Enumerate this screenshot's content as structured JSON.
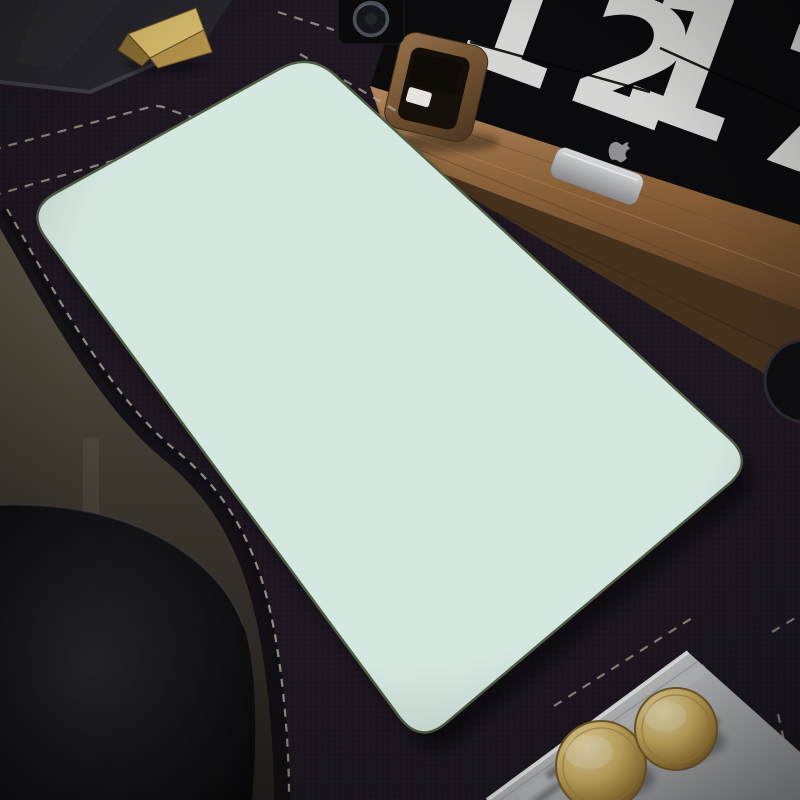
{
  "clock": {
    "hours": "12",
    "minutes": "17"
  },
  "colors": {
    "mat": "#1e1722",
    "matFleck": "#2e2433",
    "stitch": "#b3ada2",
    "floorTop": "#554e3f",
    "floorBottom": "#27231f",
    "chairLight": "#232327",
    "chairDark": "#0a0a0c",
    "woodLight": "#aa7e51",
    "woodMid": "#8a6038",
    "woodDark": "#5e4126",
    "woodFront": "#46311d",
    "screen": "#0b0b0d",
    "digit": "#d5d5d3",
    "appleGray": "#909092",
    "standLight": "#d3d5d7",
    "standDark": "#8e9093",
    "clockWoodL": "#8e6b45",
    "clockWoodD": "#523a23",
    "clockFace": "#150f09",
    "clockCard": "#e7e4dd",
    "speaker": "#0a0a0c",
    "speakerRing": "#4a4e57",
    "lid": "#26262c",
    "lidEdge": "#47474f",
    "goldL": "#dabe6c",
    "goldM": "#b5934a",
    "goldD": "#8a6f33",
    "disc": "#0e0e10",
    "discRing": "#2c2c31",
    "boxL": "#dcdddf",
    "boxM": "#b9babd",
    "boxD": "#929498",
    "knobL": "#f0e0ab",
    "knobM": "#d4b166",
    "knobD": "#8e7236",
    "padBase": "#a9c98c",
    "leafLight": "#c3dba4",
    "leafPale": "#ddeac8",
    "leafMid": "#93bd74",
    "leafDeep": "#7dab62",
    "padOutline": "#3c4c32",
    "mint": "#d5e8df",
    "wind": "#64756b",
    "cream": "#f0ead6",
    "white": "#f8f5ec",
    "yellow": "#eed699",
    "tan": "#e2bf7e",
    "bunny": "#fcfaf2"
  },
  "pad": {
    "corners": {
      "left": [
        25,
        210
      ],
      "top": [
        310,
        52
      ],
      "right": [
        755,
        462
      ],
      "bottom": [
        420,
        745
      ]
    },
    "corner_radius": 35,
    "illustration": {
      "border_leaf_counts": [
        46,
        78,
        60,
        84
      ],
      "seed": 11,
      "clumps": [
        [
          598,
          528,
          14,
          55
        ],
        [
          430,
          168,
          8,
          34
        ],
        [
          150,
          340,
          10,
          40
        ],
        [
          255,
          555,
          10,
          45
        ]
      ],
      "flowers": [
        {
          "t": "tulip",
          "x": 232,
          "y": 213,
          "s": 1.0,
          "r": -120
        },
        {
          "t": "cloud_white",
          "x": 292,
          "y": 197,
          "s": 0.85,
          "r": 10
        },
        {
          "t": "cloud_white",
          "x": 326,
          "y": 256,
          "s": 0.7,
          "r": -15
        },
        {
          "t": "cloud_yellow",
          "x": 253,
          "y": 241,
          "s": 1.0,
          "r": 0
        },
        {
          "t": "cloud_white",
          "x": 296,
          "y": 382,
          "s": 1.05,
          "r": 20
        },
        {
          "t": "cloud_white",
          "x": 668,
          "y": 413,
          "s": 0.8,
          "r": 0
        },
        {
          "t": "cloud_yellow",
          "x": 462,
          "y": 524,
          "s": 0.85,
          "r": 25
        },
        {
          "t": "cloud_yellow",
          "x": 333,
          "y": 500,
          "s": 1.35,
          "r": -10
        },
        {
          "t": "tulip",
          "x": 295,
          "y": 486,
          "s": 0.9,
          "r": -30
        },
        {
          "t": "cloud_yellow",
          "x": 352,
          "y": 612,
          "s": 1.1,
          "r": 15
        },
        {
          "t": "cloud_cream",
          "x": 694,
          "y": 437,
          "s": 0.75,
          "r": 40
        },
        {
          "t": "cloud_cream",
          "x": 718,
          "y": 503,
          "s": 0.8,
          "r": 0
        },
        {
          "t": "cloud_cream",
          "x": 311,
          "y": 133,
          "s": 0.95,
          "r": 0
        },
        {
          "t": "cloud_cream",
          "x": 342,
          "y": 140,
          "s": 0.8,
          "r": 30
        },
        {
          "t": "cloud_yellow",
          "x": 241,
          "y": 123,
          "s": 0.6,
          "r": 0
        },
        {
          "t": "tulip",
          "x": 88,
          "y": 172,
          "s": 0.9,
          "r": -35
        },
        {
          "t": "tulip",
          "x": 62,
          "y": 250,
          "s": 0.95,
          "r": -15
        },
        {
          "t": "tulip",
          "x": 85,
          "y": 273,
          "s": 0.8,
          "r": 20
        },
        {
          "t": "tulip",
          "x": 58,
          "y": 302,
          "s": 0.85,
          "r": -40
        },
        {
          "t": "tulip",
          "x": 92,
          "y": 322,
          "s": 0.75,
          "r": 10
        },
        {
          "t": "tulip",
          "x": 232,
          "y": 446,
          "s": 0.85,
          "r": -25
        },
        {
          "t": "cloud_yellow",
          "x": 562,
          "y": 658,
          "s": 0.9,
          "r": 0
        },
        {
          "t": "cloud_cream",
          "x": 270,
          "y": 162,
          "s": 0.7,
          "r": 0
        },
        {
          "t": "cloud_white",
          "x": 180,
          "y": 95,
          "s": 0.6,
          "r": 0
        },
        {
          "t": "tulip",
          "x": 430,
          "y": 178,
          "s": 0.7,
          "r": 160
        },
        {
          "t": "cloud_cream",
          "x": 152,
          "y": 128,
          "s": 0.7,
          "r": 0
        },
        {
          "t": "cloud_yellow",
          "x": 208,
          "y": 105,
          "s": 0.55,
          "r": 0
        }
      ],
      "leaves": [
        [
          196,
          195,
          40,
          0.9
        ],
        [
          316,
          232,
          10,
          0.7
        ],
        [
          422,
          157,
          -15,
          0.85
        ],
        [
          452,
          166,
          20,
          0.8
        ],
        [
          570,
          429,
          5,
          0.9
        ],
        [
          412,
          537,
          -20,
          0.95
        ],
        [
          513,
          548,
          10,
          0.7
        ],
        [
          618,
          468,
          25,
          0.7
        ],
        [
          247,
          318,
          -30,
          0.6
        ],
        [
          365,
          300,
          15,
          0.6
        ]
      ],
      "sprigs": [
        [
          288,
          295,
          -20,
          1.0
        ],
        [
          395,
          350,
          -8,
          1.15
        ],
        [
          244,
          224,
          140,
          0.9
        ]
      ],
      "wind": [
        [
          183,
          170,
          252,
          183
        ],
        [
          150,
          251,
          206,
          261
        ],
        [
          262,
          341,
          333,
          352
        ],
        [
          303,
          364,
          344,
          370
        ],
        [
          429,
          420,
          499,
          431
        ],
        [
          417,
          457,
          467,
          465
        ],
        [
          543,
          471,
          608,
          481
        ],
        [
          419,
          585,
          466,
          595
        ],
        [
          293,
          443,
          312,
          447
        ],
        [
          530,
          392,
          566,
          398
        ]
      ],
      "bunny": {
        "x": 348,
        "y": 430,
        "rot": -12
      }
    }
  }
}
